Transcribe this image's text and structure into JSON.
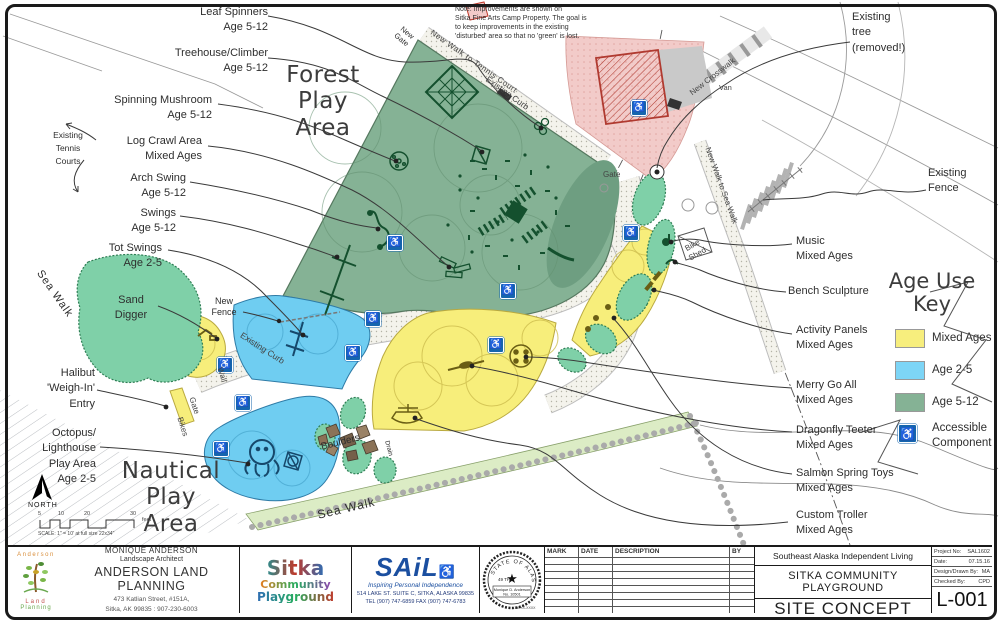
{
  "sheet": {
    "number": "L-001"
  },
  "note": {
    "line1": "Note:  Improvements are shown on",
    "line2": "Sitka Fine Arts Camp Property.  The goal is",
    "line3": "to keep improvements in the existing",
    "line4": "'disturbed' area so that no 'green' is lost."
  },
  "area_titles": {
    "forest": [
      "Forest",
      "Play",
      "Area"
    ],
    "nautical": [
      "Nautical",
      "Play",
      "Area"
    ]
  },
  "features_left": [
    {
      "lines": [
        "Leaf Spinners",
        "Age 5-12"
      ]
    },
    {
      "lines": [
        "Treehouse/Climber",
        "Age 5-12"
      ]
    },
    {
      "lines": [
        "Spinning Mushroom",
        "Age 5-12"
      ]
    },
    {
      "lines": [
        "Log Crawl Area",
        "Mixed Ages"
      ]
    },
    {
      "lines": [
        "Arch Swing",
        "Age 5-12"
      ]
    },
    {
      "lines": [
        "Swings",
        "Age 5-12"
      ]
    },
    {
      "lines": [
        "Tot Swings",
        "Age 2-5"
      ]
    },
    {
      "lines": [
        "Sand",
        "Digger"
      ]
    },
    {
      "lines": [
        "Halibut",
        "'Weigh-In'",
        "Entry"
      ]
    },
    {
      "lines": [
        "Octopus/",
        "Lighthouse",
        "Play Area",
        "Age 2-5"
      ]
    }
  ],
  "features_right": [
    {
      "lines": [
        "Existing",
        "tree",
        "(removed!)"
      ]
    },
    {
      "lines": [
        "Existing",
        "Fence"
      ]
    },
    {
      "lines": [
        "Music",
        "Mixed Ages"
      ]
    },
    {
      "lines": [
        "Bench Sculpture"
      ]
    },
    {
      "lines": [
        "Activity Panels",
        "Mixed Ages"
      ]
    },
    {
      "lines": [
        "Merry Go All",
        "Mixed Ages"
      ]
    },
    {
      "lines": [
        "Dragonfly Teeter",
        "Mixed Ages"
      ]
    },
    {
      "lines": [
        "Salmon Spring Toys",
        "Mixed Ages"
      ]
    },
    {
      "lines": [
        "Custom Troller",
        "Mixed Ages"
      ]
    }
  ],
  "map_labels": {
    "existing_tennis": [
      "Existing",
      "Tennis",
      "Courts"
    ],
    "new_gate": [
      "New",
      "Gate"
    ],
    "new_walk_tennis": "New Walk to Tennis Court",
    "existing_curb": "Existing Curb",
    "gate": "Gate",
    "van": "Van",
    "new_crosswalk": "New Crosswalk",
    "new_walk_sea": "New Walk to Sea Walk",
    "bike_shed": [
      "Bike",
      "Shed"
    ],
    "new_fence": [
      "New",
      "Fence"
    ],
    "wall": "Wall",
    "bikes": "Bikes",
    "sea_walk": "Sea Walk",
    "boulders": "Boulders",
    "drain": "Drain"
  },
  "legend": {
    "title": [
      "Age Use",
      "Key"
    ],
    "items": [
      {
        "label": "Mixed Ages",
        "color": "#f7ee7d",
        "css": "background:#f7ee7d"
      },
      {
        "label": "Age 2-5",
        "color": "#7dd5f6",
        "css": "background:#7dd5f6"
      },
      {
        "label": "Age 5-12",
        "color": "#85b295",
        "css": "background:#85b295"
      }
    ],
    "accessible": {
      "lines": [
        "Accessible",
        "Component"
      ]
    }
  },
  "compass": {
    "label": "NORTH"
  },
  "scalebar": {
    "ticks": [
      "5",
      "10",
      "20",
      "30"
    ],
    "unit": "feet",
    "caption": "SCALE: 1\" = 10' at full size 22x34\""
  },
  "titleblock": {
    "anderson": {
      "logo_word1": "Anderson",
      "logo_word2": "Land",
      "logo_word3": "Planning",
      "person": "MONIQUE ANDERSON",
      "role": "Landscape Architect",
      "firm": "ANDERSON LAND PLANNING",
      "address1": "473 Katlian Street, #151A,",
      "address2": "Sitka, AK 99835 : 907-230-6003"
    },
    "sitka_logo": {
      "word1": "Sitka",
      "word2": "Community",
      "word3": "Playground"
    },
    "sail": {
      "name": "SAiL",
      "wheelchair": "♿",
      "tagline": "Inspiring Personal Independence",
      "address1": "514 LAKE ST. SUITE C, SITKA, ALASKA 99835",
      "address2": "TEL (907) 747-6859   FAX (907) 747-6783"
    },
    "seal": {
      "arc_text": "STATE OF ALASKA",
      "star": "★",
      "forty_nine": "49 TH",
      "name": "Monique D. Anderson",
      "reg_no": "No. 10501",
      "date": "XX-XX-XXXX"
    },
    "revisions": {
      "headers": [
        "MARK",
        "DATE",
        "DESCRIPTION",
        "BY"
      ]
    },
    "project": {
      "client": "Southeast Alaska Independent Living",
      "name": "SITKA COMMUNITY PLAYGROUND",
      "sheet_title": "SITE CONCEPT LAYOUT",
      "fields": [
        {
          "label": "Project No:",
          "value": "SAL1602"
        },
        {
          "label": "Date:",
          "value": "07.15.16"
        },
        {
          "label": "Design/Drawn By:",
          "value": "MA"
        },
        {
          "label": "Checked By:",
          "value": "CPD"
        }
      ],
      "sheet_number": "L-001"
    }
  },
  "colors": {
    "age_5_12_green": "#85b295",
    "age_2_5_blue": "#6fcdf1",
    "mixed_ages_yellow": "#f7ee7b",
    "accessible_blue": "#1565ae",
    "disturbed_pink": "#f2cbc9",
    "sea_walk_green": "#dcecc5"
  }
}
